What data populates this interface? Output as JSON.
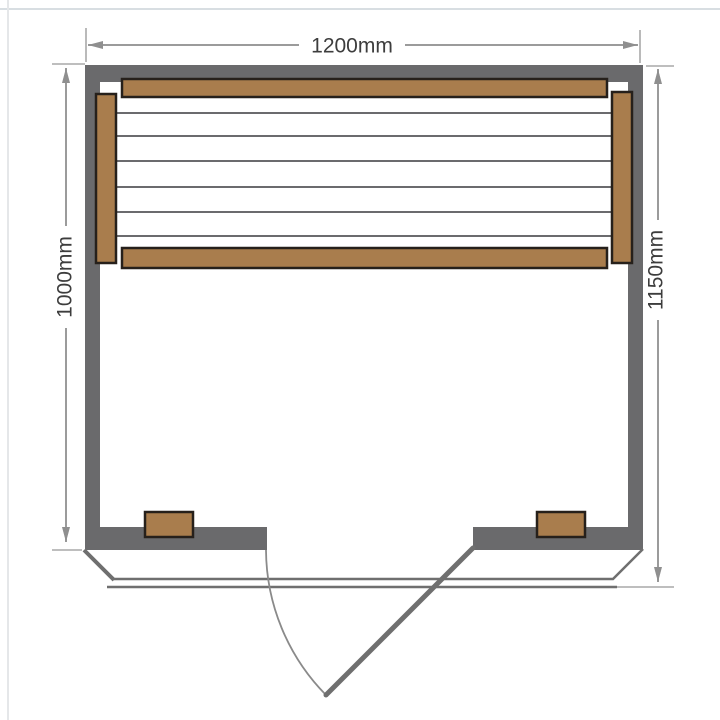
{
  "dimensions": {
    "width_top": {
      "label": "1200mm"
    },
    "depth_left": {
      "label": "1000mm"
    },
    "depth_right": {
      "label": "1150mm"
    }
  },
  "colors": {
    "wall": "#6a6a6c",
    "wood": "#a97d4d",
    "woodBorder": "#26201b",
    "outline": "#6f6f6f",
    "slat": "#56565a",
    "dimLine": "#9b9b9b",
    "dimText": "#3d3d3d",
    "frame": "#d8dee2"
  }
}
